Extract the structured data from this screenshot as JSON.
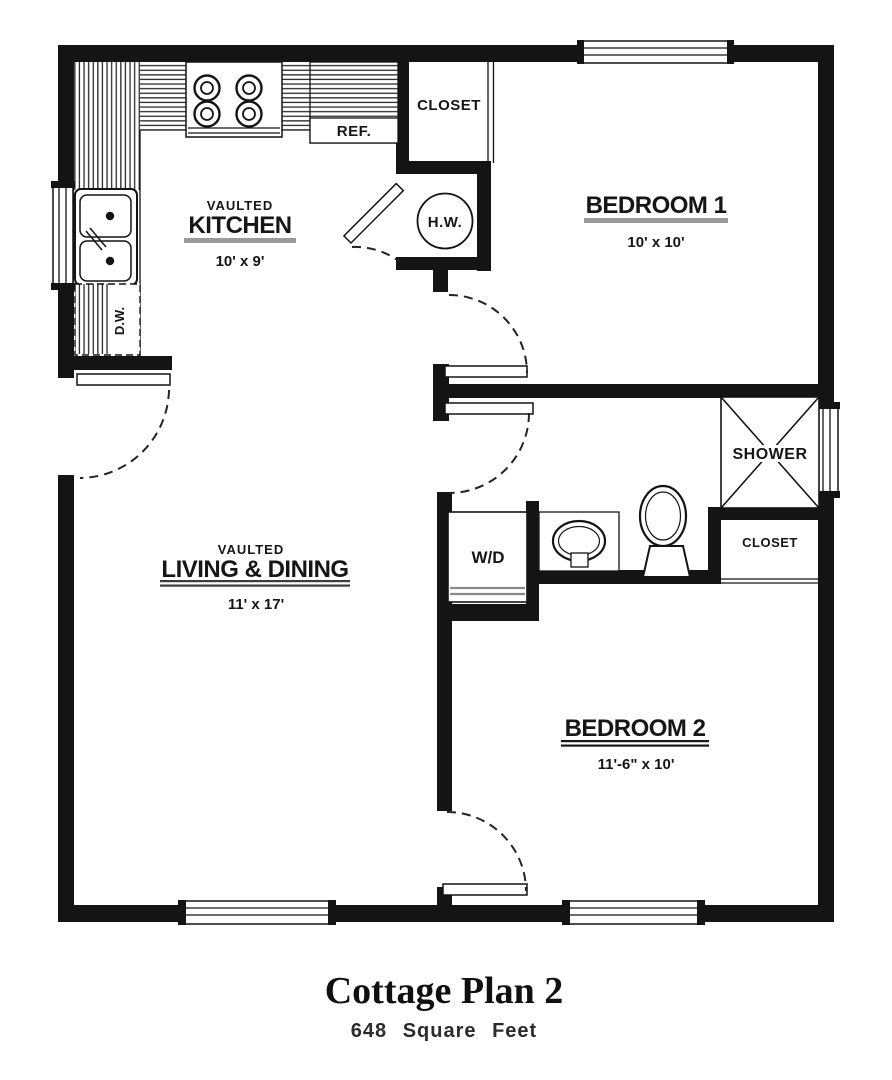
{
  "plan": {
    "title": "Cottage Plan 2",
    "subtitle": "648 Square Feet"
  },
  "rooms": {
    "kitchen": {
      "prefix": "VAULTED",
      "name": "KITCHEN",
      "dims": "10' x 9'"
    },
    "living": {
      "prefix": "VAULTED",
      "name": "LIVING & DINING",
      "dims": "11' x 17'"
    },
    "bedroom1": {
      "name": "BEDROOM 1",
      "dims": "10' x 10'"
    },
    "bedroom2": {
      "name": "BEDROOM 2",
      "dims": "11'-6\" x 10'"
    }
  },
  "fixtures": {
    "closet_top": "CLOSET",
    "closet_bath": "CLOSET",
    "shower": "SHOWER",
    "water_heater": "H.W.",
    "refrigerator": "REF.",
    "washer_dryer": "W/D",
    "dishwasher": "D.W."
  },
  "colors": {
    "wall": "#141414",
    "underline_gray": "#9a9a9a",
    "underline_dark": "#3c3c3c"
  }
}
